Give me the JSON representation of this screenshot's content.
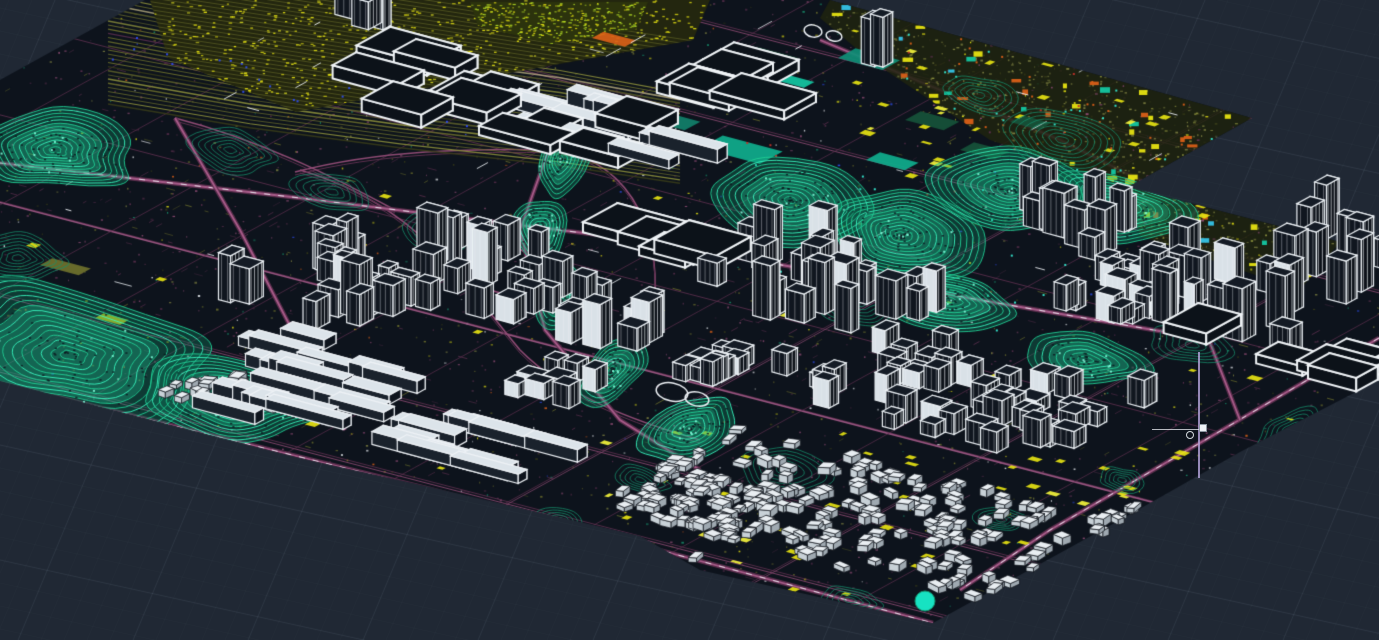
{
  "viewport": {
    "width": 1379,
    "height": 640
  },
  "palette": {
    "background": "#202834",
    "grid_line": "#b4c4d4",
    "map_base": "#0d131c",
    "white": "#eef2f6",
    "magenta_dark": "#5f3050",
    "magenta_main": "#8f4b74",
    "magenta_bright": "#b06090",
    "cyan_bright": "#2df2b2",
    "cyan_mid": "#21cf96",
    "cyan_dim": "#17926d",
    "teal_solid": "#14c7a2",
    "yellow": "#e6e312",
    "chartreuse": "#b8e226",
    "olive": "#6f722c",
    "khaki": "#7d8040",
    "khaki_dark": "#3a3e18",
    "orange": "#d95f18",
    "blue": "#2f4df0",
    "red": "#c03028",
    "lavender": "#b9a8e0"
  },
  "grid": {
    "gentle_slope": 0.22,
    "steep_dxdy": -0.417,
    "minor_step": 23,
    "major_every": 5,
    "minor_alpha": 0.035,
    "major_alpha": 0.1
  },
  "projection": {
    "axis_a": [
      0.966,
      0.259
    ],
    "axis_b": [
      0.876,
      -0.482
    ]
  },
  "seed": 20240731,
  "map_outline": [
    [
      145,
      0
    ],
    [
      830,
      0
    ],
    [
      1252,
      118
    ],
    [
      1128,
      187
    ],
    [
      1379,
      252
    ],
    [
      1379,
      380
    ],
    [
      1240,
      452
    ],
    [
      1120,
      520
    ],
    [
      1000,
      586
    ],
    [
      933,
      623
    ],
    [
      700,
      570
    ],
    [
      640,
      536
    ],
    [
      430,
      487
    ],
    [
      300,
      458
    ],
    [
      0,
      381
    ],
    [
      0,
      80
    ]
  ],
  "zones": {
    "yard_poly": [
      [
        150,
        0
      ],
      [
        710,
        0
      ],
      [
        693,
        40
      ],
      [
        470,
        80
      ],
      [
        296,
        112
      ],
      [
        168,
        58
      ]
    ],
    "chartreuse_poly": [
      [
        470,
        2
      ],
      [
        648,
        2
      ],
      [
        636,
        30
      ],
      [
        552,
        44
      ],
      [
        478,
        26
      ]
    ],
    "ne_tile_poly": [
      [
        830,
        0
      ],
      [
        1252,
        118
      ],
      [
        1128,
        187
      ],
      [
        990,
        140
      ],
      [
        870,
        60
      ],
      [
        820,
        18
      ]
    ],
    "east_tile_poly": [
      [
        1128,
        187
      ],
      [
        1340,
        242
      ],
      [
        1300,
        290
      ],
      [
        1140,
        236
      ]
    ],
    "corridor_path": [
      [
        108,
        50
      ],
      [
        250,
        76
      ],
      [
        400,
        98
      ],
      [
        560,
        118
      ],
      [
        680,
        138
      ]
    ],
    "corridor_strands": 13,
    "corridor_halfwidth": 27
  },
  "roads": {
    "street_spacing_a": 86,
    "street_spacing_b": 80,
    "arterials": [
      {
        "pts": [
          [
            0,
            163
          ],
          [
            300,
            198
          ],
          [
            640,
            240
          ],
          [
            980,
            300
          ],
          [
            1200,
            338
          ]
        ],
        "dashes": true
      },
      {
        "pts": [
          [
            1379,
            338
          ],
          [
            1205,
            440
          ],
          [
            1050,
            530
          ],
          [
            960,
            590
          ]
        ],
        "dashes": true
      },
      {
        "pts": [
          [
            820,
            40
          ],
          [
            1060,
            140
          ],
          [
            1160,
            190
          ]
        ],
        "dashes": false
      },
      {
        "pts": [
          [
            175,
            118
          ],
          [
            240,
            230
          ],
          [
            300,
            345
          ],
          [
            345,
            430
          ]
        ],
        "dashes": false
      },
      {
        "pts": [
          [
            560,
            118
          ],
          [
            520,
            230
          ],
          [
            545,
            330
          ],
          [
            620,
            420
          ],
          [
            700,
            470
          ]
        ],
        "dashes": false
      },
      {
        "pts": [
          [
            0,
            383
          ],
          [
            430,
            489
          ],
          [
            933,
            623
          ]
        ],
        "dashes": true
      },
      {
        "pts": [
          [
            1252,
            118
          ],
          [
            1190,
            220
          ],
          [
            1205,
            330
          ],
          [
            1240,
            420
          ]
        ],
        "dashes": false
      }
    ],
    "ramps": [
      [
        300,
        170,
        420,
        205,
        465,
        285,
        520,
        350
      ],
      [
        520,
        350,
        565,
        395,
        630,
        420,
        700,
        440
      ],
      [
        295,
        172,
        380,
        150,
        470,
        148,
        560,
        150
      ],
      [
        560,
        150,
        640,
        168,
        658,
        240,
        655,
        300
      ],
      [
        175,
        118,
        260,
        140,
        330,
        175,
        395,
        210
      ]
    ],
    "ring_road": [
      490,
      262,
      58,
      26,
      0.42
    ]
  },
  "contours": [
    [
      70,
      355,
      150,
      72,
      0.18,
      "b"
    ],
    [
      235,
      400,
      88,
      40,
      0.18,
      "b"
    ],
    [
      55,
      150,
      85,
      40,
      0.15,
      "b"
    ],
    [
      18,
      258,
      50,
      26,
      0.1,
      "d"
    ],
    [
      560,
      160,
      38,
      24,
      -1.1,
      "b"
    ],
    [
      540,
      228,
      34,
      26,
      -1.2,
      "b"
    ],
    [
      562,
      295,
      36,
      26,
      -1.3,
      "b"
    ],
    [
      612,
      370,
      42,
      26,
      -0.9,
      "b"
    ],
    [
      690,
      428,
      52,
      28,
      -0.4,
      "b"
    ],
    [
      782,
      470,
      46,
      22,
      0.2,
      "d"
    ],
    [
      790,
      200,
      82,
      42,
      0.15,
      "b"
    ],
    [
      900,
      235,
      85,
      45,
      0.18,
      "b"
    ],
    [
      1010,
      190,
      80,
      40,
      0.2,
      "b"
    ],
    [
      1120,
      207,
      70,
      36,
      0.22,
      "b"
    ],
    [
      950,
      300,
      70,
      32,
      0.2,
      "b"
    ],
    [
      858,
      300,
      50,
      26,
      0.2,
      "d"
    ],
    [
      1062,
      140,
      60,
      28,
      0.2,
      "d"
    ],
    [
      1085,
      360,
      62,
      26,
      0.2,
      "b"
    ],
    [
      1192,
      345,
      45,
      20,
      0.2,
      "d"
    ],
    [
      1292,
      430,
      38,
      20,
      -0.5,
      "d"
    ],
    [
      978,
      95,
      40,
      18,
      0.2,
      "d"
    ],
    [
      640,
      480,
      30,
      14,
      0.2,
      "d"
    ],
    [
      560,
      520,
      22,
      12,
      0.2,
      "d"
    ],
    [
      1002,
      520,
      26,
      12,
      0.15,
      "d"
    ],
    [
      1122,
      480,
      24,
      12,
      0.15,
      "d"
    ],
    [
      850,
      600,
      34,
      12,
      0.15,
      "d"
    ],
    [
      230,
      150,
      45,
      22,
      0.2,
      "d"
    ],
    [
      332,
      192,
      40,
      20,
      0.2,
      "d"
    ],
    [
      432,
      232,
      36,
      18,
      0.2,
      "d"
    ]
  ],
  "solid_blocks": [
    [
      757,
      95,
      36,
      16,
      "#d95f18"
    ],
    [
      775,
      80,
      30,
      12,
      "#14c7a2"
    ],
    [
      700,
      148,
      62,
      26,
      "#0fae8d"
    ],
    [
      646,
      120,
      40,
      18,
      "#11806a"
    ],
    [
      838,
      58,
      46,
      20,
      "#0f8f77"
    ],
    [
      905,
      120,
      40,
      18,
      "#16523a"
    ],
    [
      960,
      150,
      36,
      16,
      "#16523a"
    ],
    [
      866,
      160,
      40,
      16,
      "#0fae8d"
    ],
    [
      592,
      38,
      34,
      13,
      "#d95f18"
    ],
    [
      1010,
      122,
      30,
      14,
      "#16523a"
    ],
    [
      745,
      55,
      40,
      16,
      "#123f2e"
    ],
    [
      688,
      96,
      28,
      12,
      "#0fae8d"
    ],
    [
      40,
      265,
      40,
      14,
      "#6f722c"
    ],
    [
      95,
      318,
      26,
      10,
      "#c8c414"
    ]
  ],
  "rings": [
    [
      813,
      31,
      9,
      6
    ],
    [
      834,
      36,
      8,
      5
    ],
    [
      672,
      392,
      16,
      9
    ],
    [
      697,
      399,
      12,
      7
    ]
  ],
  "discs": [
    [
      445,
      630,
      13
    ],
    [
      925,
      601,
      10
    ],
    [
      698,
      594,
      5
    ]
  ],
  "clusters": [
    [
      "hall",
      470,
      112,
      150,
      42,
      11
    ],
    [
      "hall",
      700,
      85,
      70,
      28,
      6
    ],
    [
      "hall",
      640,
      246,
      60,
      16,
      4
    ],
    [
      "hall",
      1255,
      355,
      110,
      28,
      5
    ],
    [
      "slab",
      575,
      125,
      95,
      30,
      13
    ],
    [
      "slab",
      340,
      410,
      110,
      45,
      16
    ],
    [
      "slab",
      470,
      452,
      90,
      36,
      12
    ],
    [
      "slab",
      300,
      362,
      70,
      24,
      8
    ],
    [
      "tower",
      315,
      295,
      65,
      48,
      16
    ],
    [
      "tower",
      475,
      285,
      75,
      55,
      20
    ],
    [
      "tower",
      610,
      330,
      45,
      35,
      9
    ],
    [
      "tower",
      815,
      295,
      105,
      52,
      24
    ],
    [
      "tower",
      1055,
      232,
      65,
      32,
      12
    ],
    [
      "tower",
      1235,
      300,
      95,
      65,
      22
    ],
    [
      "tower",
      940,
      18,
      70,
      16,
      7
    ],
    [
      "tower",
      330,
      14,
      45,
      12,
      5
    ],
    [
      "tower",
      875,
      68,
      16,
      20,
      2
    ],
    [
      "tower",
      1332,
      255,
      48,
      32,
      9
    ],
    [
      "mid",
      950,
      400,
      130,
      62,
      42
    ],
    [
      "mid",
      1122,
      302,
      58,
      38,
      14
    ],
    [
      "mid",
      735,
      375,
      40,
      30,
      10
    ],
    [
      "mid",
      560,
      392,
      40,
      24,
      8
    ],
    [
      "house",
      880,
      525,
      230,
      80,
      190
    ],
    [
      "house",
      700,
      505,
      70,
      45,
      55
    ],
    [
      "house",
      215,
      395,
      55,
      26,
      26
    ],
    [
      "house",
      610,
      560,
      60,
      28,
      30
    ],
    [
      "house",
      1150,
      535,
      60,
      33,
      25
    ]
  ],
  "details": {
    "speckle_count": 2800,
    "stroke_count": 620,
    "yellow_rect_count": 130,
    "white_seg_count": 42,
    "blue_dot_count": 45,
    "orange_dot_count": 25,
    "cyan_dot_count": 40,
    "red_dot_count": 12
  },
  "marker": {
    "line": {
      "x": 1198,
      "y1": 352,
      "y2": 478
    },
    "grip": {
      "x": 1199,
      "y": 424,
      "size": 8
    },
    "snap_circle": {
      "x": 1186,
      "y": 431,
      "size": 8
    },
    "tick": {
      "x": 1152,
      "y": 429,
      "w": 47
    }
  }
}
